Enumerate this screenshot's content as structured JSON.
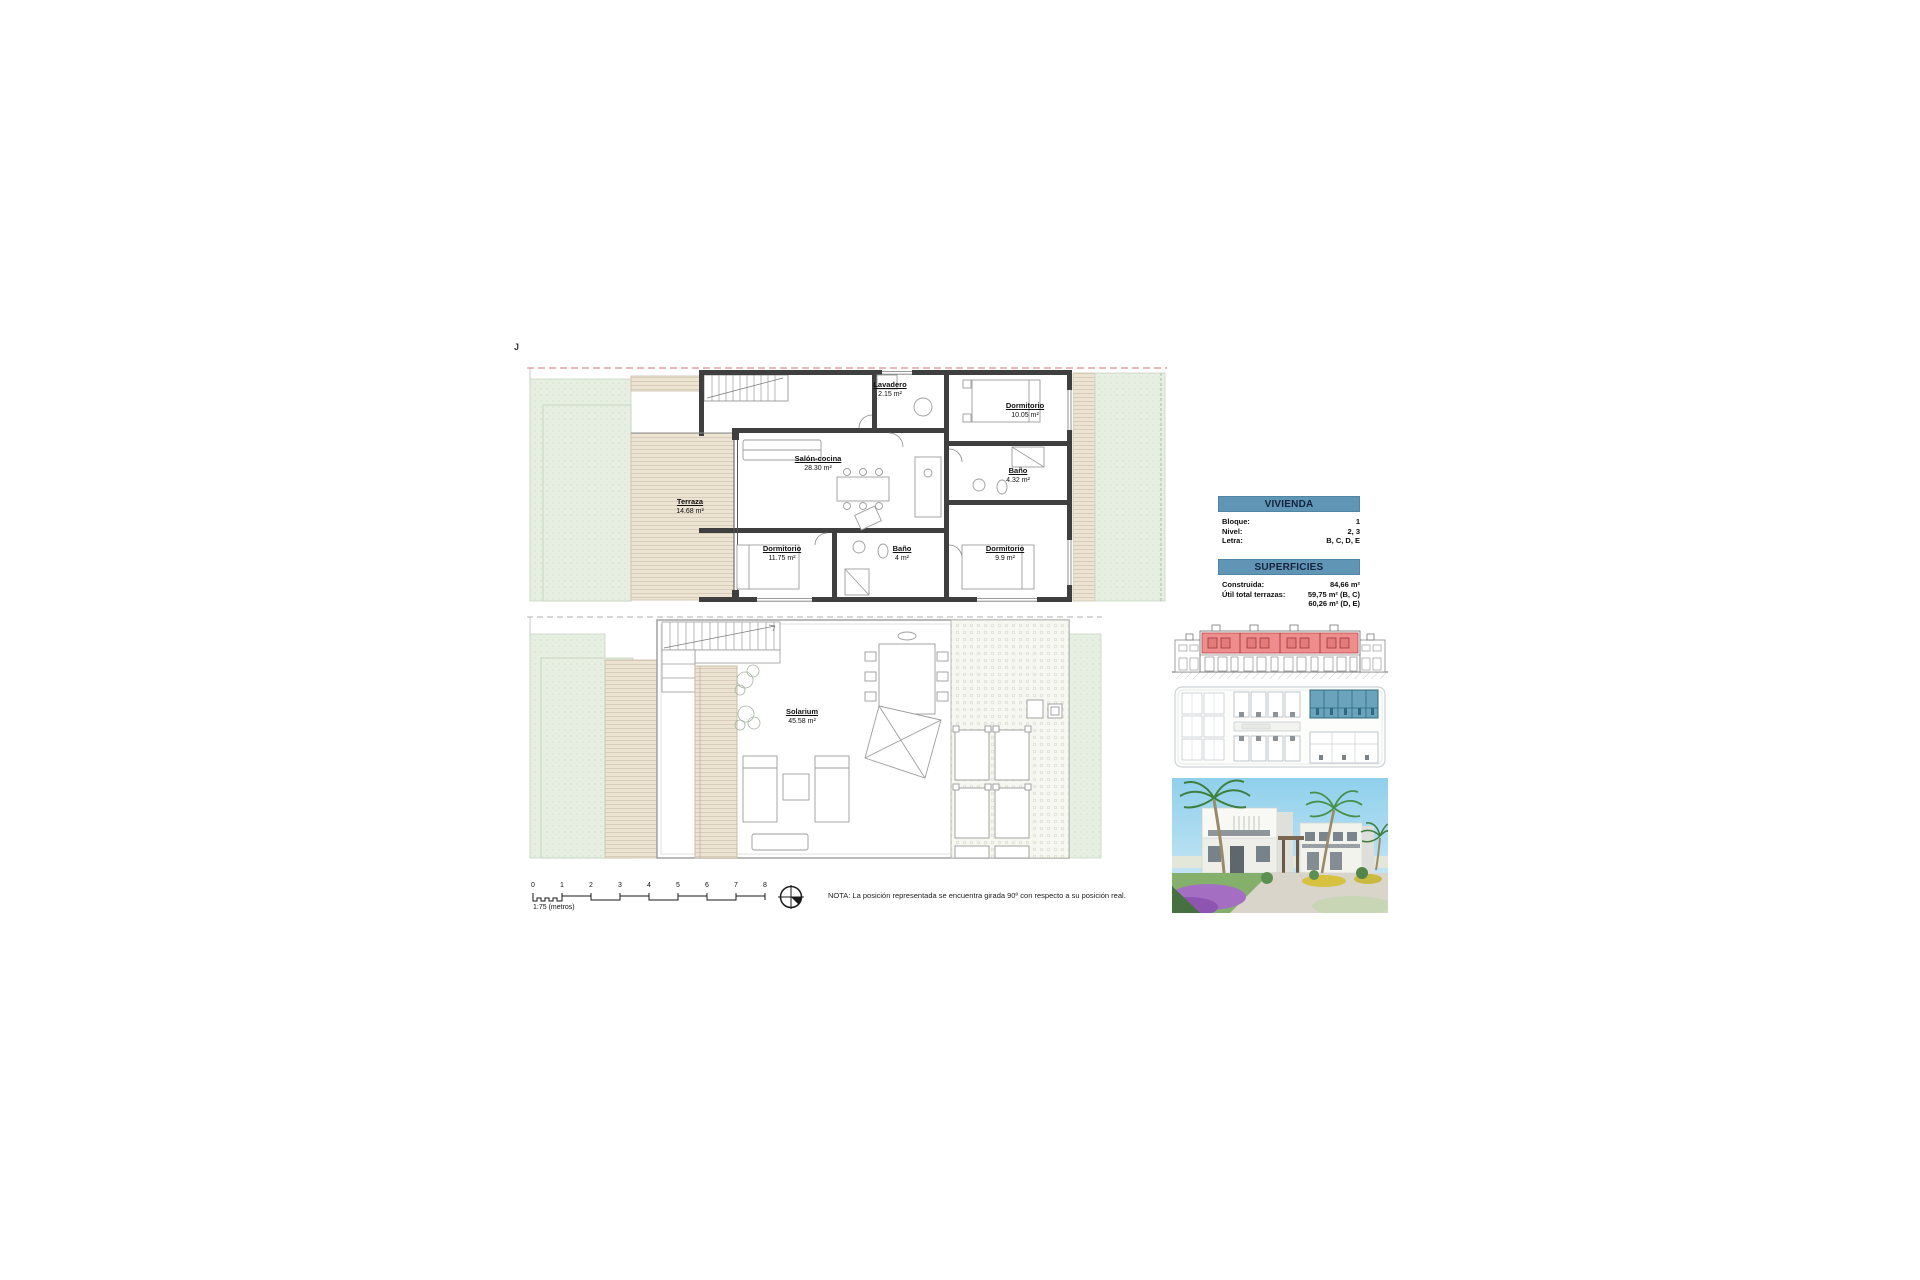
{
  "page": {
    "marker": "J"
  },
  "plans": {
    "upper": {
      "rooms": [
        {
          "name": "Lavadero",
          "area": "2.15 m²"
        },
        {
          "name": "Dormitorio",
          "area": "10.05 m²"
        },
        {
          "name": "Salón-cocina",
          "area": "28.30 m²"
        },
        {
          "name": "Baño",
          "area": "4.32 m²"
        },
        {
          "name": "Terraza",
          "area": "14.68 m²"
        },
        {
          "name": "Dormitorio",
          "area": "11.75 m²"
        },
        {
          "name": "Baño",
          "area": "4 m²"
        },
        {
          "name": "Dormitorio",
          "area": "9.9 m²"
        }
      ]
    },
    "solarium": {
      "rooms": [
        {
          "name": "Solarium",
          "area": "45.58 m²"
        }
      ]
    }
  },
  "info": {
    "vivienda": {
      "title": "VIVIENDA",
      "rows": [
        {
          "label": "Bloque:",
          "value": "1"
        },
        {
          "label": "Nivel:",
          "value": "2, 3"
        },
        {
          "label": "Letra:",
          "value": "B, C, D, E"
        }
      ]
    },
    "superficies": {
      "title": "SUPERFICIES",
      "rows": [
        {
          "label": "Construida:",
          "value": "84,66 m²"
        },
        {
          "label": "Útil total terrazas:",
          "value": "59,75 m² (B, C)"
        },
        {
          "label": "",
          "value": "60,26 m² (D, E)"
        }
      ]
    }
  },
  "footer": {
    "scale_ticks": [
      "0",
      "1",
      "2",
      "3",
      "4",
      "5",
      "6",
      "7",
      "8"
    ],
    "scale_label": "1:75 (metros)",
    "note": "NOTA: La posición representada se encuentra girada 90º con respecto a su posición real."
  },
  "colors": {
    "header_blue": "#6195b5",
    "highlight_red": "#ef8d8d",
    "highlight_blue": "#6ba3bd",
    "deck_beige": "#ece3d3",
    "garden_green": "#e7efe3",
    "wall_dark": "#3f3f3f"
  }
}
